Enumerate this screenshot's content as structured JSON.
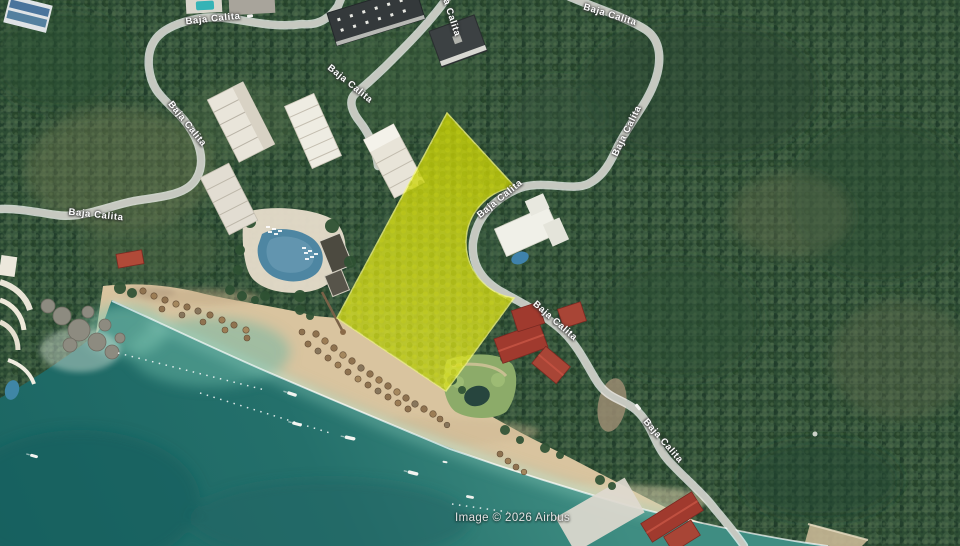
{
  "map": {
    "road_name": "Baja Calita",
    "attribution": "Image © 2026 Airbus",
    "overlay": {
      "type": "highlighted-parcel",
      "fill_color": "#d8dd0e",
      "stroke_color": "#f4f77e"
    },
    "colors": {
      "ocean_deep": "#1b6663",
      "ocean_shallow": "#6fbcab",
      "sand": "#d9c49f",
      "vegetation": "#34523a",
      "road": "#c6c8c0",
      "red_roof": "#a03a2e",
      "pool_blue": "#4e86a2"
    }
  }
}
